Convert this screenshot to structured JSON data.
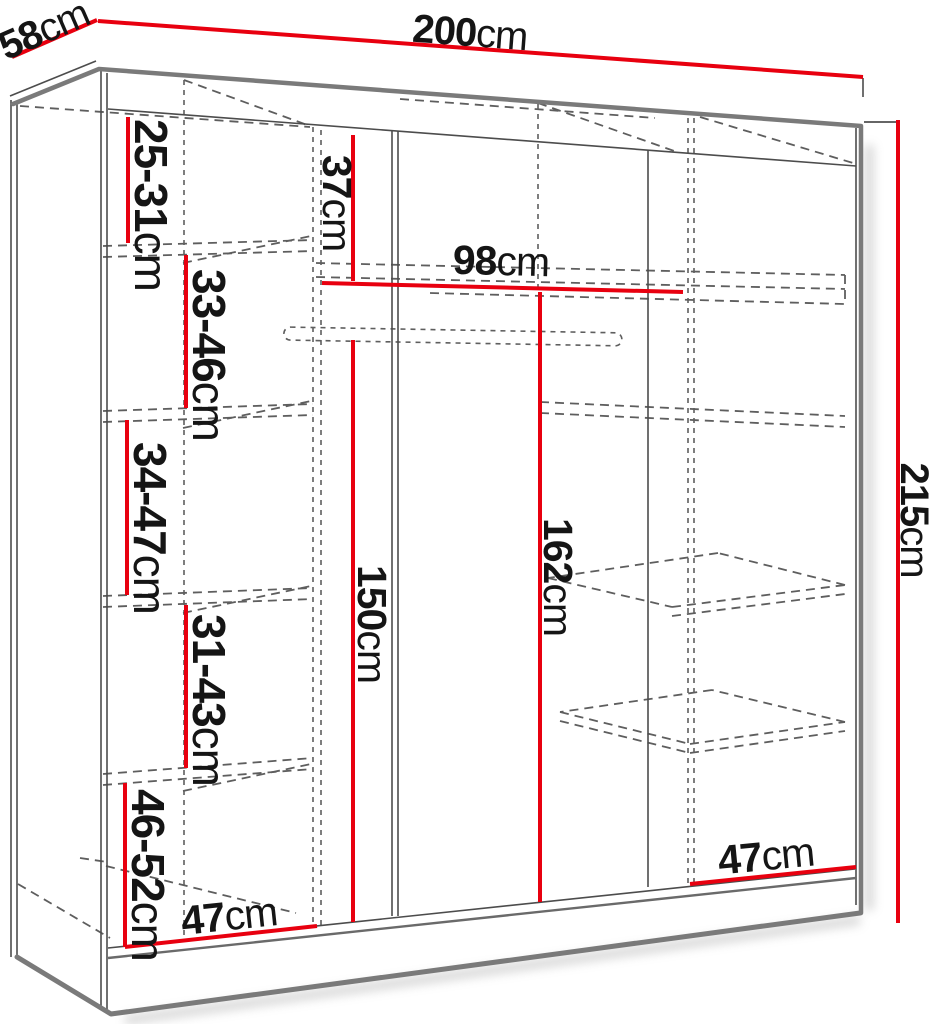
{
  "diagram": {
    "title": "Wardrobe interior dimensions diagram",
    "unit": "cm",
    "colors": {
      "dimension_line": "#e8000f",
      "outline": "#7a7a7a",
      "hidden_line": "#5e5e5e",
      "text": "#151515",
      "background": "#ffffff"
    },
    "dimensions": {
      "width": {
        "value": "200",
        "unit": "cm"
      },
      "depth": {
        "value": "58",
        "unit": "cm"
      },
      "height": {
        "value": "215",
        "unit": "cm"
      },
      "left_shelf_1": {
        "value": "25-31",
        "unit": "cm"
      },
      "left_shelf_2": {
        "value": "33-46",
        "unit": "cm"
      },
      "left_shelf_3": {
        "value": "34-47",
        "unit": "cm"
      },
      "left_shelf_4": {
        "value": "31-43",
        "unit": "cm"
      },
      "left_shelf_5": {
        "value": "46-52",
        "unit": "cm"
      },
      "top_shelf_height": {
        "value": "37",
        "unit": "cm"
      },
      "rail_width": {
        "value": "98",
        "unit": "cm"
      },
      "hanging_height": {
        "value": "150",
        "unit": "cm"
      },
      "right_height": {
        "value": "162",
        "unit": "cm"
      },
      "bottom_left_depth": {
        "value": "47",
        "unit": "cm"
      },
      "bottom_right_depth": {
        "value": "47",
        "unit": "cm"
      }
    }
  }
}
